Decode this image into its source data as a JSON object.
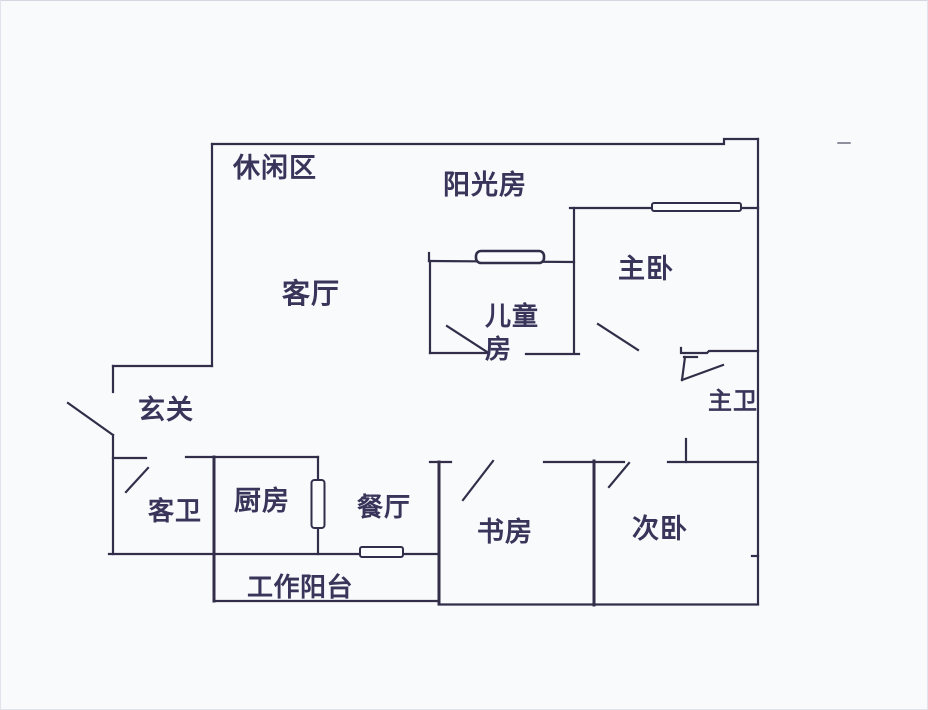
{
  "page": {
    "background_color": "#f9fafc",
    "ink_color": "#322d49",
    "description": "hand-drawn apartment floor plan"
  },
  "floorplan": {
    "rooms": [
      {
        "key": "leisure-area",
        "label": "休闲区"
      },
      {
        "key": "sun-room",
        "label": "阳光房"
      },
      {
        "key": "living-room",
        "label": "客厅"
      },
      {
        "key": "master-bedroom",
        "label": "主卧"
      },
      {
        "key": "kids-room",
        "label": "儿童\n房"
      },
      {
        "key": "entry",
        "label": "玄关"
      },
      {
        "key": "guest-bath",
        "label": "客卫"
      },
      {
        "key": "kitchen",
        "label": "厨房"
      },
      {
        "key": "dining-room",
        "label": "餐厅"
      },
      {
        "key": "study",
        "label": "书房"
      },
      {
        "key": "second-bedroom",
        "label": "次卧"
      },
      {
        "key": "master-bath",
        "label": "主卫"
      },
      {
        "key": "work-balcony",
        "label": "工作阳台"
      }
    ]
  }
}
